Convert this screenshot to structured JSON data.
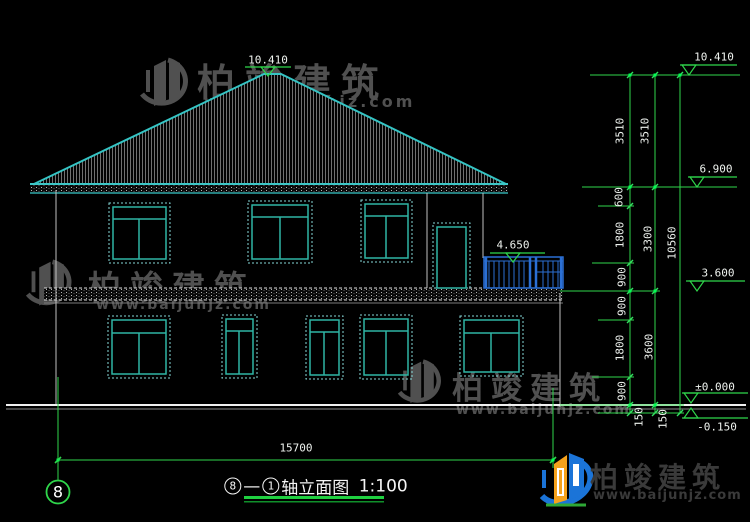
{
  "watermark": {
    "brand": "柏竣建筑",
    "site": "www.baijunjz.com"
  },
  "title": {
    "axis_a": "8",
    "dash": "—",
    "axis_b": "1",
    "name": "轴立面图",
    "scale": "1:100"
  },
  "axis_bubble": {
    "label": "8"
  },
  "levels": {
    "peak": "10.410",
    "top": "10.410",
    "eave": "6.900",
    "balcony": "4.650",
    "floor2": "3.600",
    "zero": "±0.000",
    "site": "-0.150"
  },
  "dims": {
    "overall_width": "15700",
    "overall_height": "10560",
    "inner_chain": [
      "3510",
      "600",
      "1800",
      "900",
      "900",
      "1800",
      "900",
      "150"
    ],
    "mid_chain": [
      "3510",
      "3300",
      "3600",
      "150"
    ]
  },
  "colors": {
    "line_teal": "#35c4c4",
    "window_teal": "#2fb5a5",
    "dim_green": "#2fd64b",
    "balcony_blue": "#2b6fd4",
    "axis_gray": "#c0c0c0",
    "watermark_gray": "#505050",
    "logo_blue": "#1b74d8",
    "logo_orange": "#f5a21c",
    "logo_green": "#2ea836"
  }
}
